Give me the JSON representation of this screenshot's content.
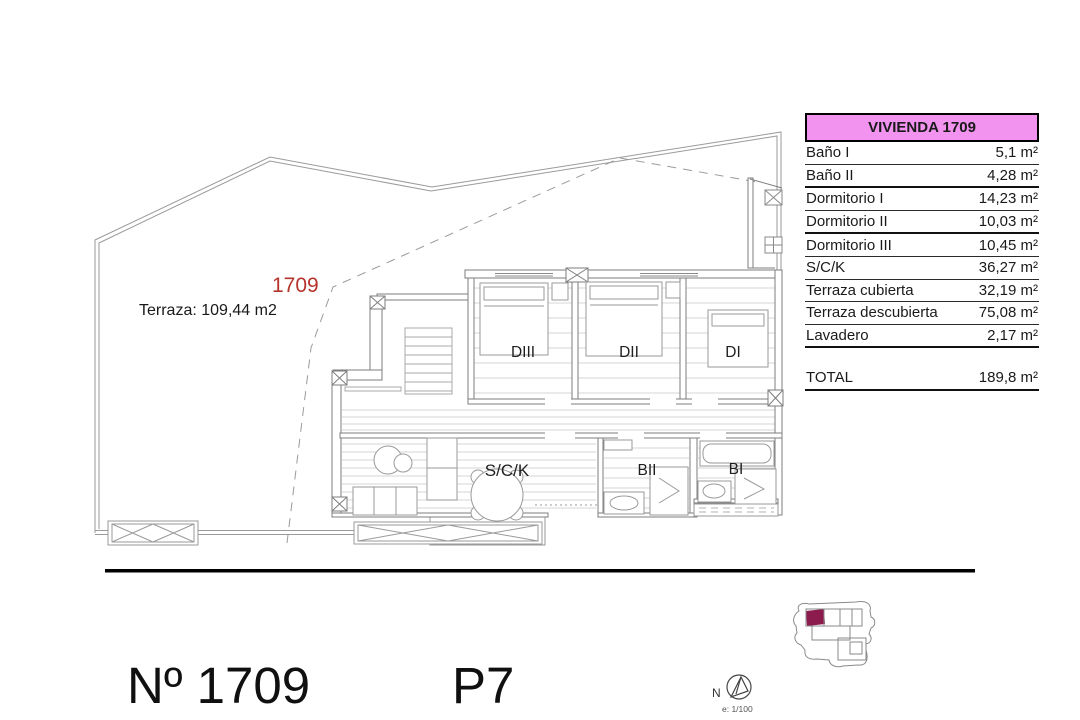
{
  "plan": {
    "unit_number": "1709",
    "unit_number_color": "#b5342c",
    "terrace_label": "Terraza: 109,44 m2",
    "rooms": [
      {
        "id": "dormitorio-3",
        "label": "DIII"
      },
      {
        "id": "dormitorio-2",
        "label": "DII"
      },
      {
        "id": "dormitorio-1",
        "label": "DI"
      },
      {
        "id": "salon-cocina",
        "label": "S/C/K"
      },
      {
        "id": "bano-2",
        "label": "BII"
      },
      {
        "id": "bano-1",
        "label": "BI"
      }
    ]
  },
  "table": {
    "title": "VIVIENDA 1709",
    "title_bg": "#f193ef",
    "rows": [
      {
        "label": "Baño I",
        "value": "5,1 m²"
      },
      {
        "label": "Baño II",
        "value": "4,28 m²"
      },
      {
        "label": "Dormitorio I",
        "value": "14,23 m²"
      },
      {
        "label": "Dormitorio II",
        "value": "10,03 m²"
      },
      {
        "label": "Dormitorio III",
        "value": "10,45 m²"
      },
      {
        "label": "S/C/K",
        "value": "36,27 m²"
      },
      {
        "label": "Terraza cubierta",
        "value": "32,19 m²"
      },
      {
        "label": "Terraza descubierta",
        "value": "75,08 m²"
      },
      {
        "label": "Lavadero",
        "value": "2,17 m²"
      }
    ],
    "total": {
      "label": "TOTAL",
      "value": "189,8 m²"
    }
  },
  "footer": {
    "unit_title": "Nº 1709",
    "floor_label": "P7"
  },
  "compass": {
    "north_label": "N",
    "scale_label": "e: 1/100"
  },
  "keyplan": {
    "highlight_color": "#8c1b4e"
  }
}
